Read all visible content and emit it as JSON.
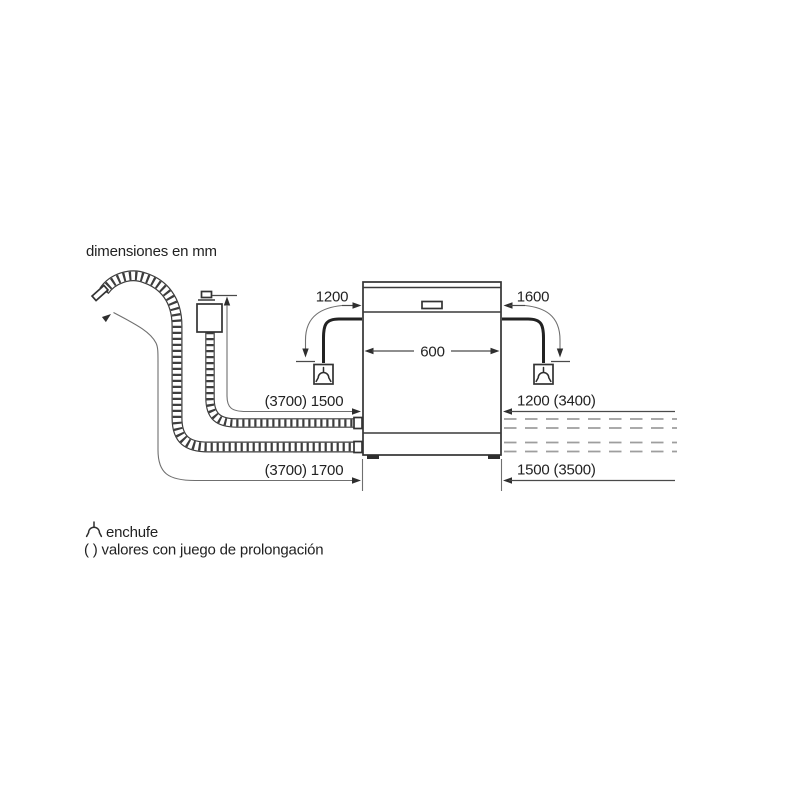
{
  "title": "dimensiones en mm",
  "colors": {
    "background": "#ffffff",
    "line_dark": "#3a3a3a",
    "line_thin": "#6f6f6f",
    "line_dashed": "#9e9e9e",
    "text": "#222222"
  },
  "icons": {
    "plug": "plug-socket-symbol",
    "tap_connector": "aquastop-tap-connector",
    "supply_hose": "corrugated-supply-hose",
    "drain_hose": "corrugated-drain-hose"
  },
  "dimensions": {
    "cable_left_drop": "1200",
    "cable_right_drop": "1600",
    "appliance_width": "600",
    "left_upper_hose_length": "(3700) 1500",
    "right_upper_length": "1200 (3400)",
    "left_lower_hose_length": "(3700) 1700",
    "right_lower_length": "1500 (3500)"
  },
  "legend": {
    "plug_label": "enchufe",
    "parentheses_note": "( ) valores con juego de prolongación"
  }
}
